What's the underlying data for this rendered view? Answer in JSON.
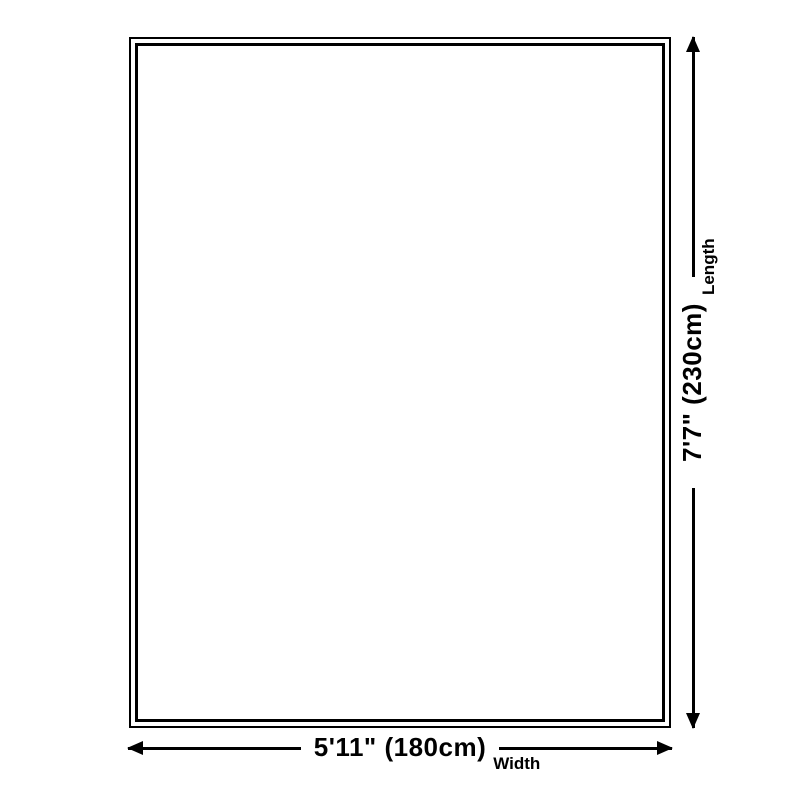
{
  "page": {
    "background_color": "#ffffff"
  },
  "diagram": {
    "kind": "rug-size-diagram",
    "outline_color": "#000000",
    "dimension_line_color": "#000000",
    "text_color": "#000000",
    "width_dimension": {
      "value": "5'11\" (180cm)",
      "label": "Width"
    },
    "length_dimension": {
      "value": "7'7\" (230cm)",
      "label": "Length"
    },
    "icons": {
      "arrow_left": "◀",
      "arrow_right": "▶",
      "arrow_up": "▲",
      "arrow_down": "▼"
    }
  }
}
